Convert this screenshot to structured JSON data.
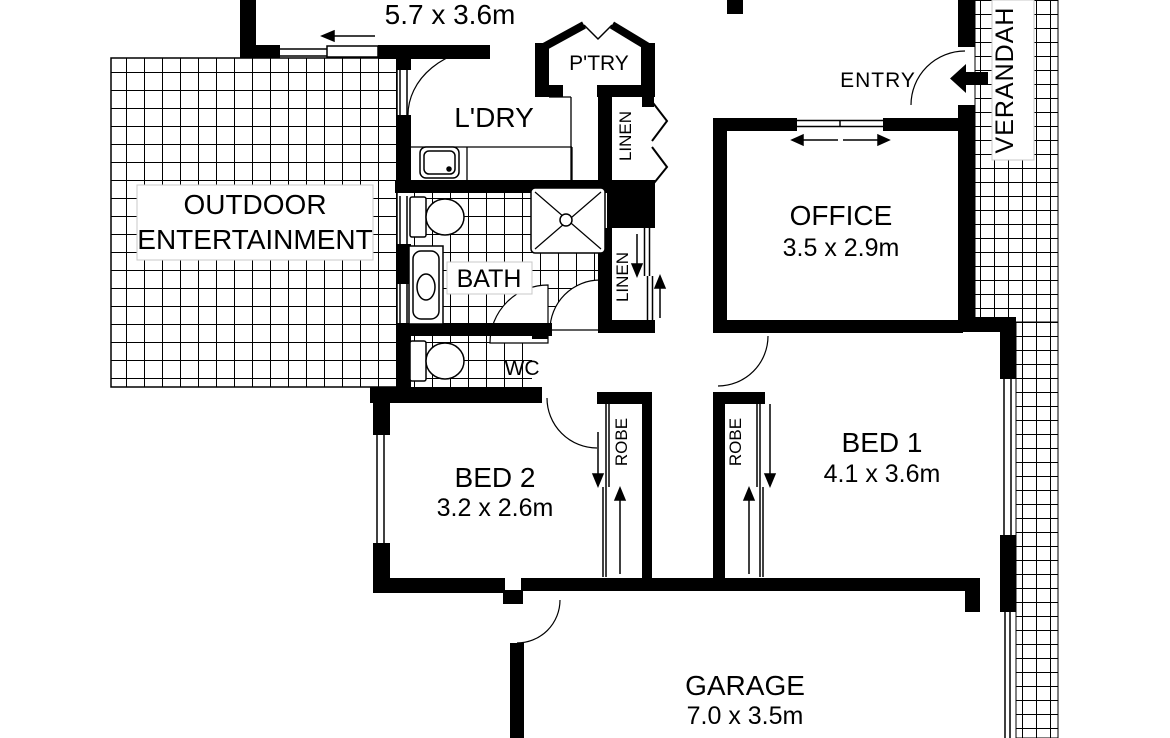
{
  "plan": {
    "top_dimension": "5.7 x 3.6m",
    "rooms": {
      "outdoor": {
        "line1": "OUTDOOR",
        "line2": "ENTERTAINMENT"
      },
      "laundry": {
        "name": "L'DRY"
      },
      "pantry": {
        "name": "P'TRY"
      },
      "linen_upper": {
        "name": "LINEN"
      },
      "linen_lower": {
        "name": "LINEN"
      },
      "bath": {
        "name": "BATH"
      },
      "wc": {
        "name": "WC"
      },
      "entry": {
        "name": "ENTRY"
      },
      "verandah": {
        "name": "VERANDAH"
      },
      "office": {
        "name": "OFFICE",
        "dim": "3.5 x 2.9m"
      },
      "bed1": {
        "name": "BED 1",
        "dim": "4.1 x 3.6m"
      },
      "bed2": {
        "name": "BED 2",
        "dim": "3.2 x 2.6m"
      },
      "robe_bed2": {
        "name": "ROBE"
      },
      "robe_bed1": {
        "name": "ROBE"
      },
      "garage": {
        "name": "GARAGE",
        "dim": "7.0 x 3.5m"
      }
    },
    "colors": {
      "wall": "#000000",
      "tile_line": "#000000",
      "background": "#ffffff"
    }
  }
}
